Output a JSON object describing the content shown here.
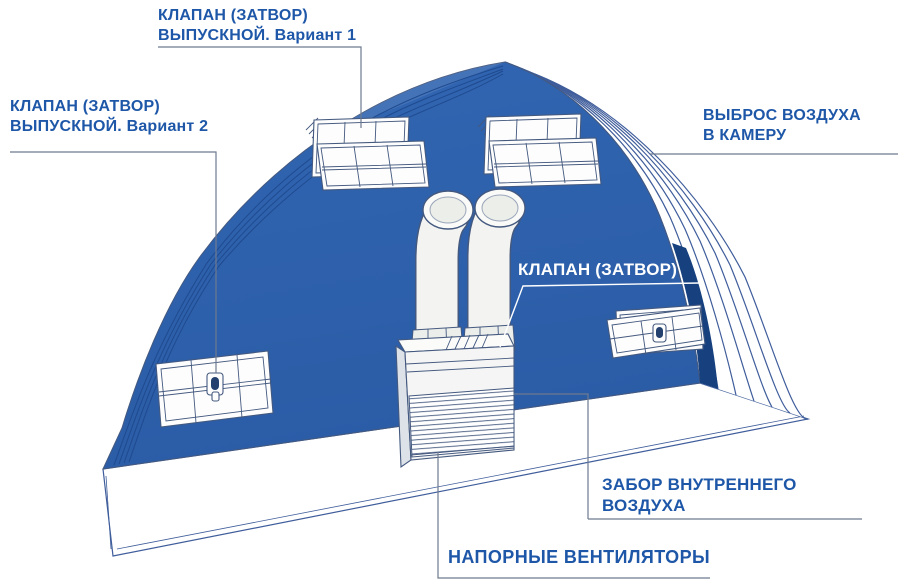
{
  "diagram": {
    "labels": {
      "valve_outlet_v1": {
        "line1": "КЛАПАН (ЗАТВОР)",
        "line2": "ВЫПУСКНОЙ. Вариант 1"
      },
      "valve_outlet_v2": {
        "line1": "КЛАПАН (ЗАТВОР)",
        "line2": "ВЫПУСКНОЙ. Вариант 2"
      },
      "air_exhaust": {
        "line1": "ВЫБРОС ВОЗДУХА",
        "line2": "В КАМЕРУ"
      },
      "valve_shutter": {
        "line1": "КЛАПАН (ЗАТВОР)"
      },
      "internal_air_intake": {
        "line1": "ЗАБОР ВНУТРЕННЕГО",
        "line2": "ВОЗДУХА"
      },
      "pressure_fans": {
        "line1": "НАПОРНЫЕ ВЕНТИЛЯТОРЫ"
      }
    },
    "colors": {
      "background": "#ffffff",
      "wall_blue": "#2b5ca6",
      "wall_blue_light": "#3166b2",
      "wall_blue_dark": "#17407f",
      "wall_contour": "#1f4a8f",
      "label_blue": "#1e57a8",
      "label_white": "#ffffff",
      "line_gray": "#6e7a90",
      "outline_blue": "#44597f",
      "drawing_stroke": "#3f5d9b"
    }
  }
}
